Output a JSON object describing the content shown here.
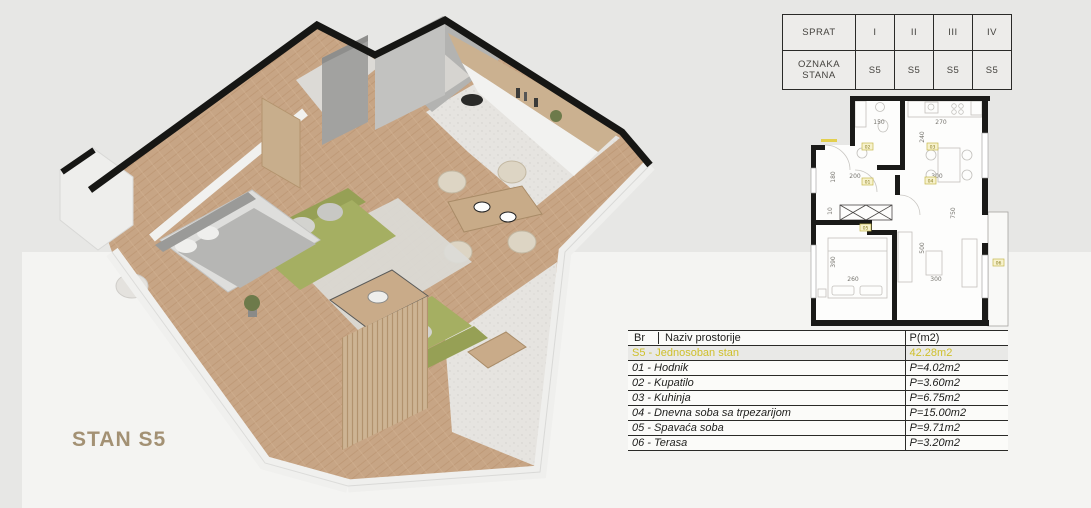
{
  "stan_label": "STAN S5",
  "floor_table": {
    "sprat_label": "SPRAT",
    "oznaka_label": "OZNAKA STANA",
    "floors": [
      "I",
      "II",
      "III",
      "IV"
    ],
    "units": [
      "S5",
      "S5",
      "S5",
      "S5"
    ]
  },
  "rooms_table": {
    "col_br": "Br",
    "col_naziv": "Naziv prostorije",
    "col_area": "P(m2)",
    "summary_label": "S5 - Jednosoban stan",
    "summary_area": "42.28m2",
    "rows": [
      {
        "label": "01 - Hodnik",
        "area": "P=4.02m2"
      },
      {
        "label": "02 - Kupatilo",
        "area": "P=3.60m2"
      },
      {
        "label": "03 - Kuhinja",
        "area": "P=6.75m2"
      },
      {
        "label": "04 - Dnevna soba sa trpezarijom",
        "area": "P=15.00m2"
      },
      {
        "label": "05 - Spavaća soba",
        "area": "P=9.71m2"
      },
      {
        "label": "06 - Terasa",
        "area": "P=3.20m2"
      }
    ]
  },
  "plan2d": {
    "dims": {
      "bath_w": "150",
      "kitchen_w": "270",
      "kitchen_h": "240",
      "entry_h": "180",
      "hall_w": "200",
      "living_w_top": "300",
      "niche": "10",
      "right_h": "750",
      "living_h": "500",
      "bedroom_h": "390",
      "bedroom_w": "260",
      "living_w": "300"
    },
    "badges": {
      "hall": "01",
      "bath": "02",
      "kitchen": "03",
      "living": "04",
      "bedroom": "05",
      "terrace": "06"
    }
  },
  "colors": {
    "highlight_text": "#cfc02c",
    "stan_label": "#a39174",
    "badge_fill": "#f7f2cd",
    "badge_border": "#c6b84e",
    "wall_black": "#161614",
    "wood_floor": "#c7a585",
    "sofa_green": "#a5af62"
  }
}
